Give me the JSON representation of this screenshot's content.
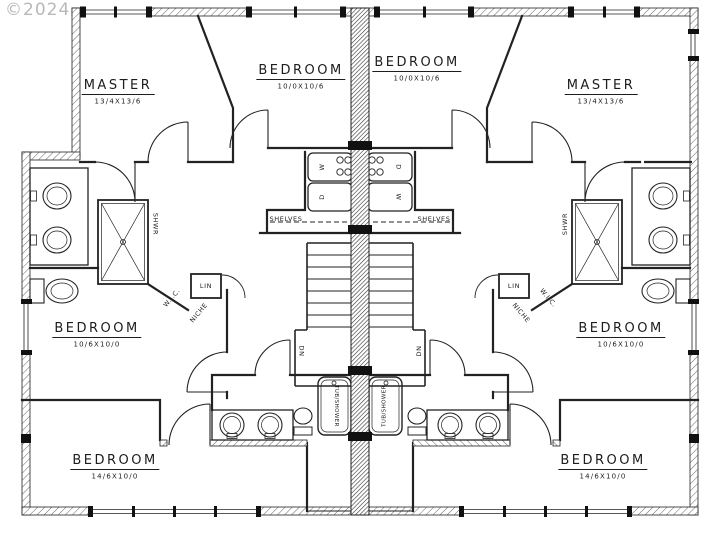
{
  "watermark": "©2024",
  "colors": {
    "paper": "#ffffff",
    "line": "#222222",
    "party_wall_fill": "#444444",
    "watermark": "#b8b8b8"
  },
  "rooms": {
    "master_left": {
      "name": "MASTER",
      "dims": "13/4X13/6"
    },
    "bedroom_top_left": {
      "name": "BEDROOM",
      "dims": "10/0X10/6"
    },
    "bedroom_top_right": {
      "name": "BEDROOM",
      "dims": "10/0X10/6"
    },
    "master_right": {
      "name": "MASTER",
      "dims": "13/4X13/6"
    },
    "bedroom_mid_left": {
      "name": "BEDROOM",
      "dims": "10/6X10/0"
    },
    "bedroom_mid_right": {
      "name": "BEDROOM",
      "dims": "10/6X10/0"
    },
    "bedroom_bottom_left": {
      "name": "BEDROOM",
      "dims": "14/6X10/0"
    },
    "bedroom_bottom_right": {
      "name": "BEDROOM",
      "dims": "14/6X10/0"
    }
  },
  "annotations": {
    "shelves_left": "SHELVES",
    "shelves_right": "SHELVES",
    "linen_left": "LIN",
    "linen_right": "LIN",
    "niche_left": "NICHE",
    "niche_right": "NICHE",
    "stairs_down_left": "DN",
    "stairs_down_right": "DN",
    "shower_left": "SHWR",
    "shower_right": "SHWR",
    "walkin_closet_left": "W.I.C.",
    "walkin_closet_right": "W.I.C.",
    "tub_left": "TUB/SHOWER",
    "tub_right": "TUB/SHOWER",
    "appliance_left_top": "W",
    "appliance_left_bottom": "D",
    "appliance_right_top": "D",
    "appliance_right_bottom": "W"
  }
}
